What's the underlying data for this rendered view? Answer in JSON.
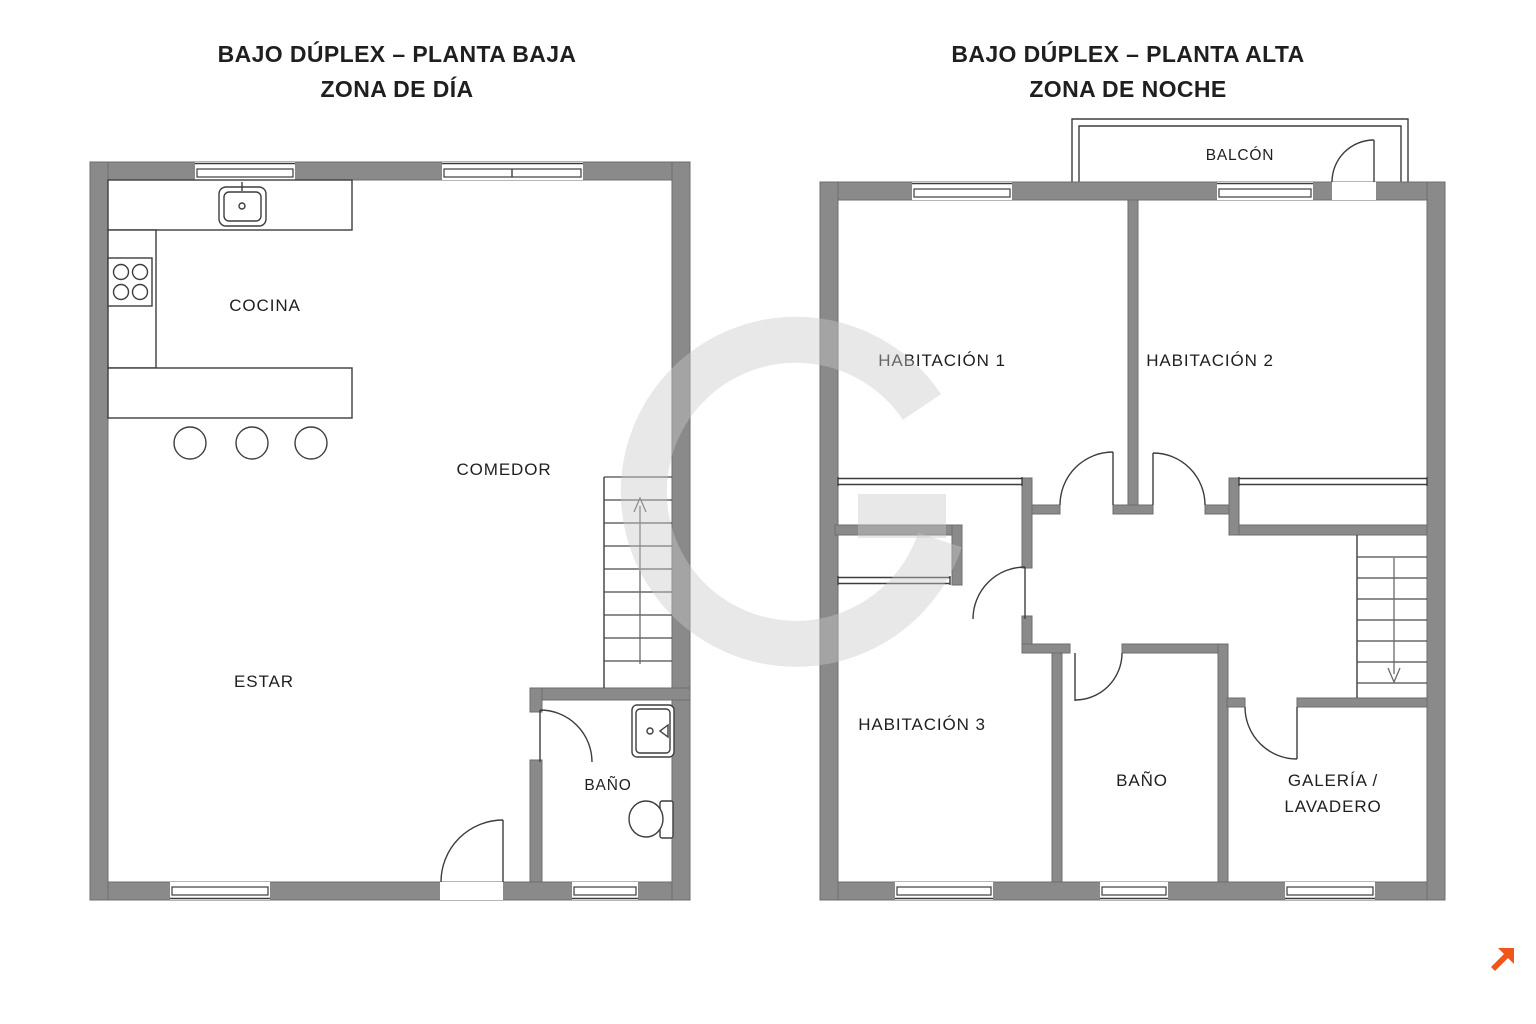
{
  "page": {
    "width": 1536,
    "height": 1024,
    "background": "#ffffff"
  },
  "colors": {
    "wall": "#8a8a8a",
    "wall_edge": "#6d6d6d",
    "line": "#3d3d3d",
    "text": "#1f1f1f",
    "watermark": "#c9c9c9",
    "logo_orange": "#F0561B"
  },
  "floor_left": {
    "title": "BAJO DÚPLEX – PLANTA BAJA",
    "subtitle": "ZONA DE DÍA",
    "labels": {
      "cocina": "COCINA",
      "comedor": "COMEDOR",
      "estar": "ESTAR",
      "bano": "BAÑO"
    }
  },
  "floor_right": {
    "title": "BAJO DÚPLEX – PLANTA ALTA",
    "subtitle": "ZONA DE NOCHE",
    "labels": {
      "balcon": "BALCÓN",
      "habitacion_1": "HABITACIÓN 1",
      "habitacion_2": "HABITACIÓN 2",
      "habitacion_3": "HABITACIÓN 3",
      "bano": "BAÑO",
      "galeria_line_1": "GALERÍA /",
      "galeria_line_2": "LAVADERO"
    }
  },
  "branding": {
    "logo": "orange-arrow",
    "color": "#F0561B"
  }
}
